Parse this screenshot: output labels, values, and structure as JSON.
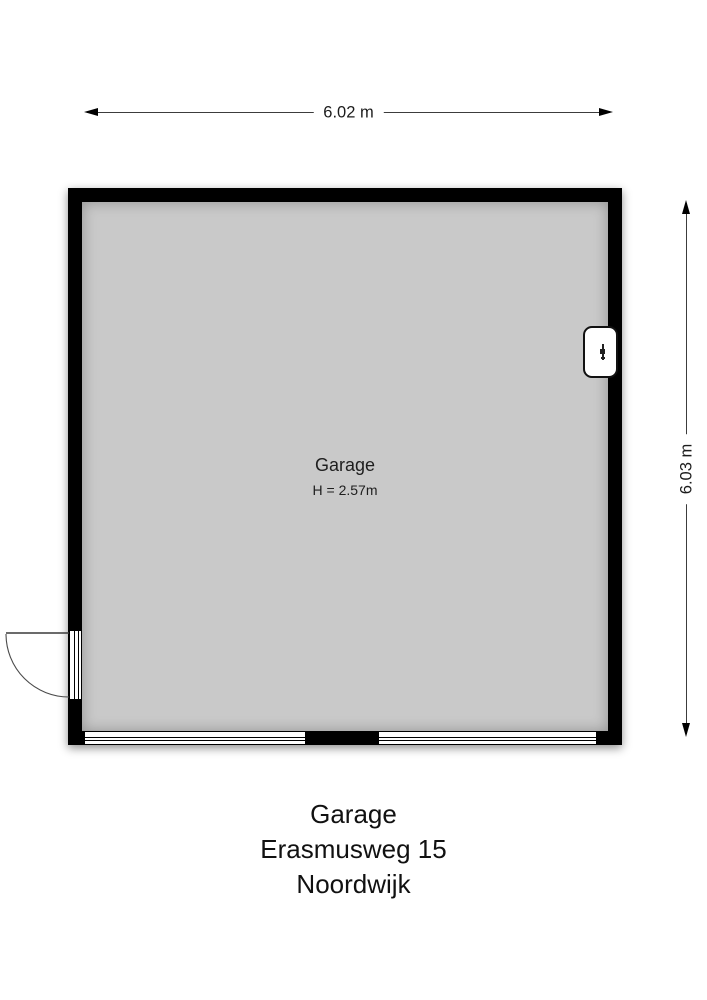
{
  "dimensions": {
    "width": "6.02 m",
    "height": "6.03 m"
  },
  "room": {
    "name": "Garage",
    "ceiling_height": "H = 2.57m"
  },
  "footer": {
    "lines": [
      "Garage",
      "Erasmusweg 15",
      "Noordwijk"
    ]
  },
  "icons": {
    "boiler": "boiler-icon",
    "door": "door-swing-arc"
  },
  "colors": {
    "wall": "#000000",
    "floor": "#c9c9c9",
    "dimension": "#3c3c3c",
    "background": "#ffffff"
  }
}
